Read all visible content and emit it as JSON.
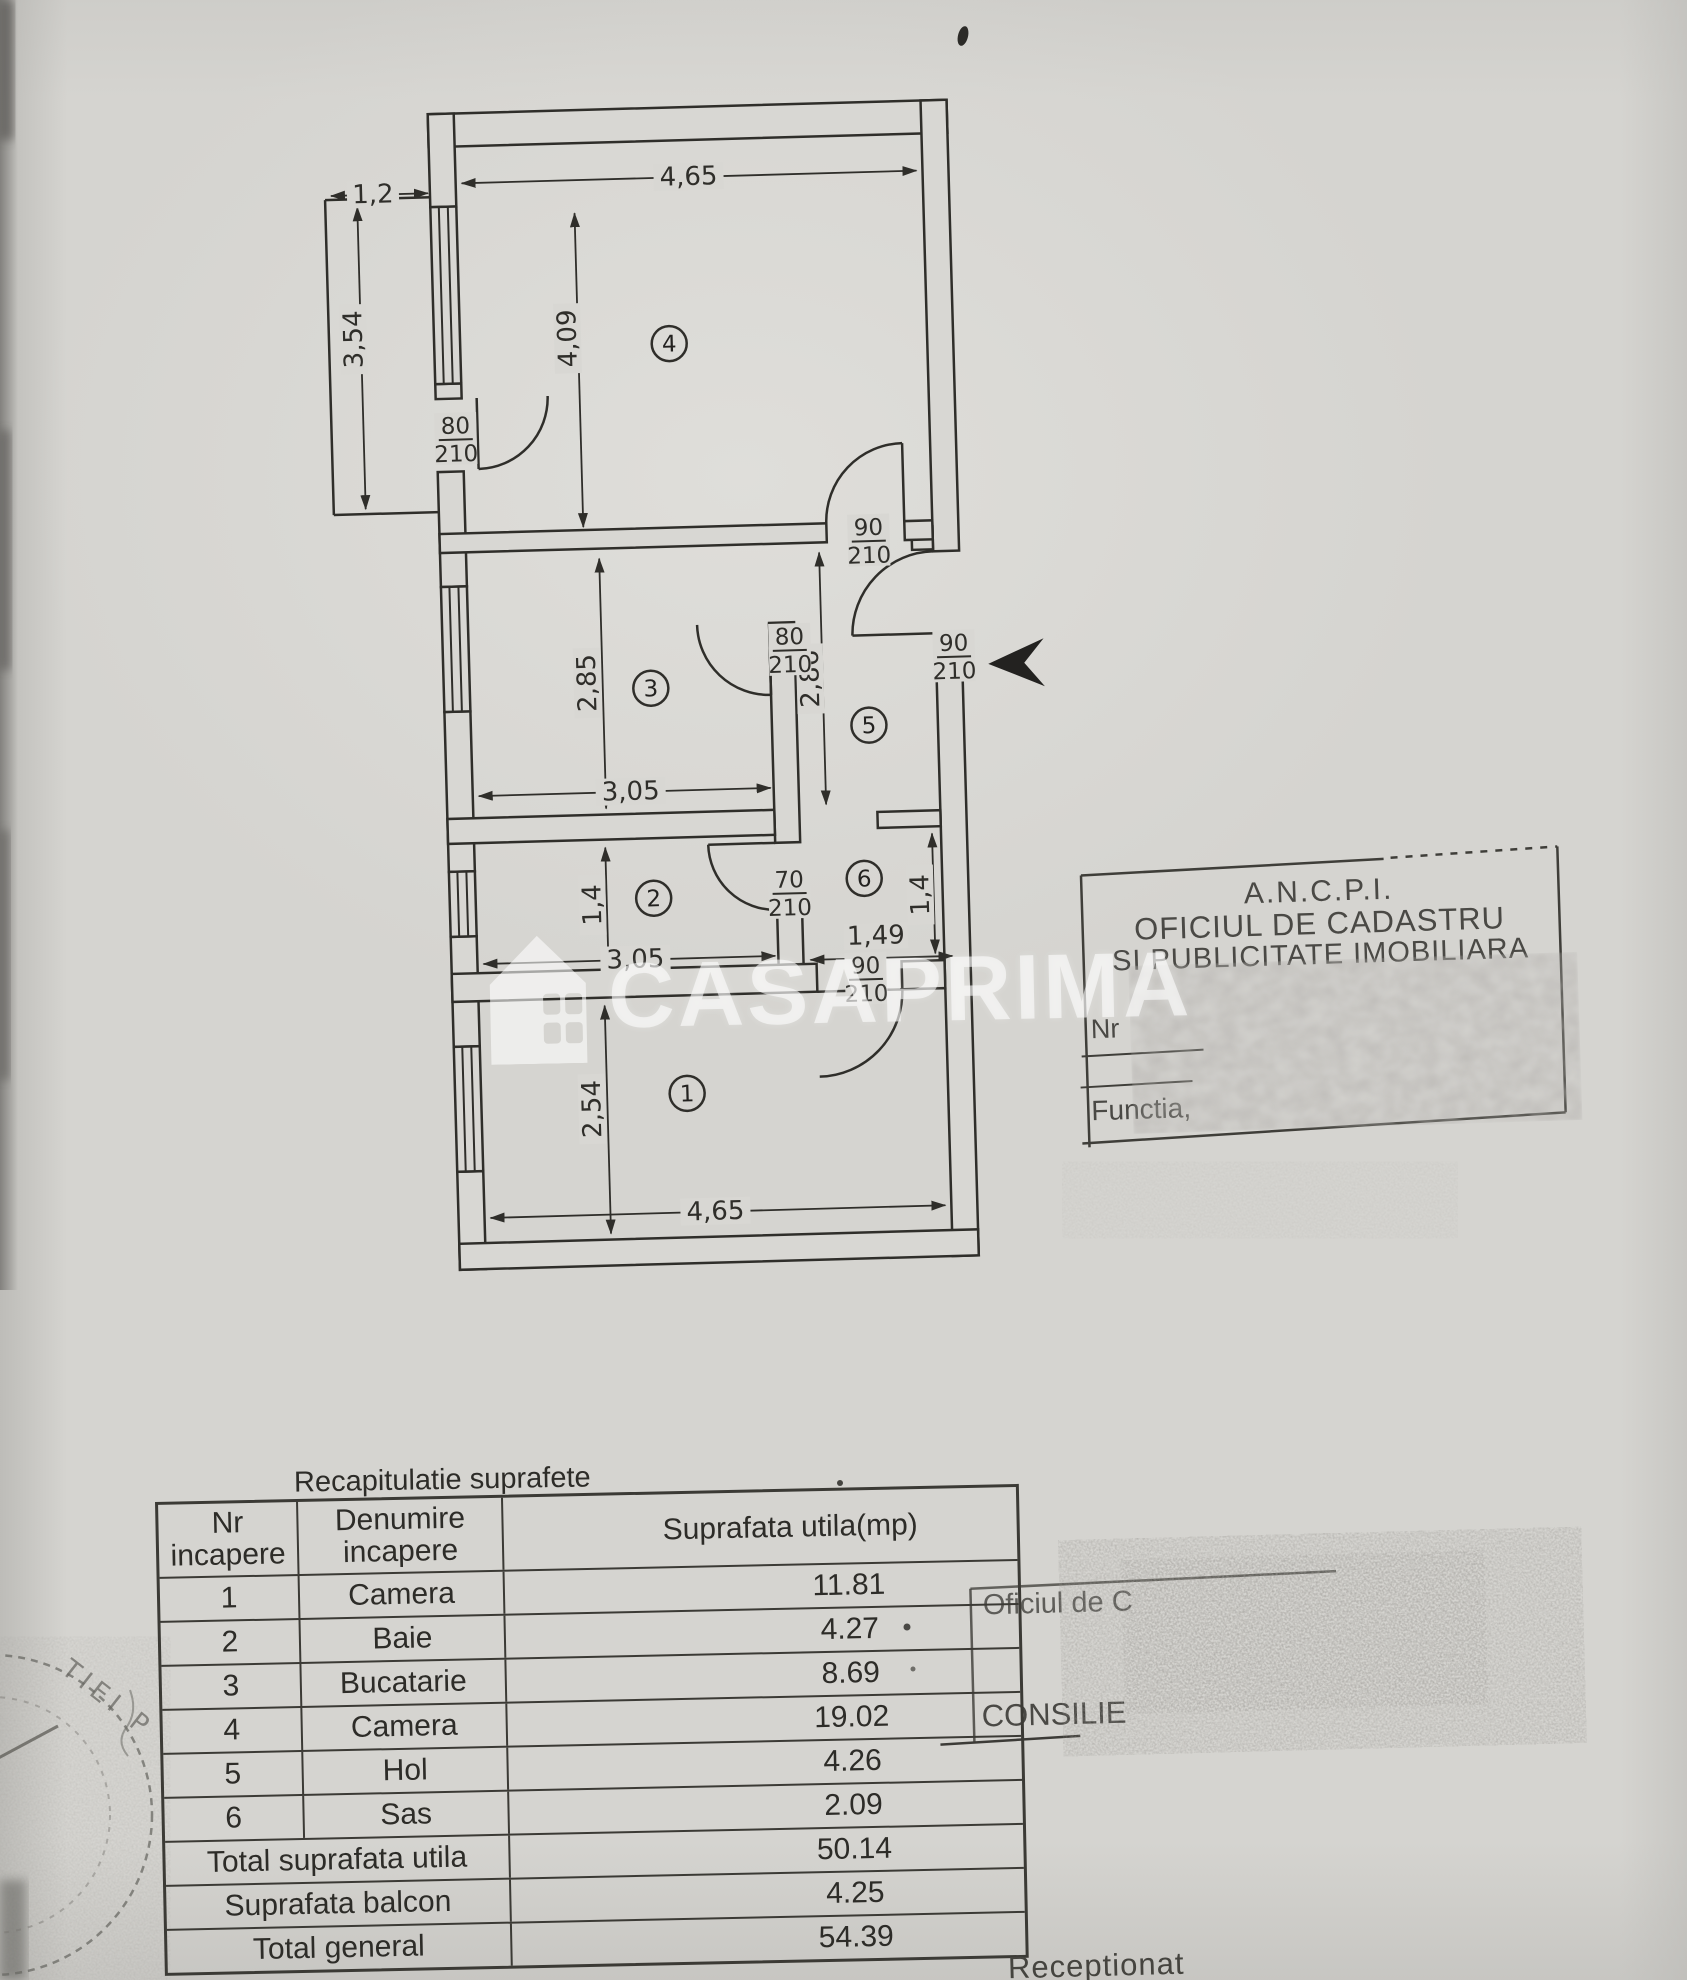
{
  "watermark": {
    "brand": "CASAPRIMA"
  },
  "plan": {
    "rooms": [
      {
        "number": "4"
      },
      {
        "number": "3"
      },
      {
        "number": "2"
      },
      {
        "number": "1"
      },
      {
        "number": "5"
      },
      {
        "number": "6"
      }
    ],
    "dims": {
      "balcony_w": "1,2",
      "balcony_h": "3,54",
      "room4_w": "4,65",
      "room4_h": "4,09",
      "room3_h": "2,85",
      "room3_w": "3,05",
      "hall_h": "2,86",
      "room2_h": "1,4",
      "room2_w": "3,05",
      "sas_h": "1,4",
      "sas_w": "1,49",
      "room1_h": "2,54",
      "room1_w": "4,65"
    },
    "doors": [
      {
        "w": "80",
        "h": "210"
      },
      {
        "w": "90",
        "h": "210"
      },
      {
        "w": "80",
        "h": "210"
      },
      {
        "w": "90",
        "h": "210"
      },
      {
        "w": "70",
        "h": "210"
      },
      {
        "w": "90",
        "h": "210"
      }
    ]
  },
  "ancpi_stamp": {
    "org": "A.N.C.P.I.",
    "line2": "OFICIUL DE CADASTRU",
    "line3": "SI PUBLICITATE IMOBILIARA",
    "nr_label": "Nr",
    "functie_label": "Functia,"
  },
  "office_stamp": {
    "line1": "Oficiul de C",
    "line2": "CONSILIE"
  },
  "round_stamp": {
    "arc_text": "TIEI P"
  },
  "page": {
    "receptionat_label": "Receptionat"
  },
  "table": {
    "title": "Recapitulatie suprafete",
    "headers": {
      "col1_line1": "Nr",
      "col1_line2": "incapere",
      "col2_line1": "Denumire",
      "col2_line2": "incapere",
      "col3": "Suprafata utila(mp)"
    },
    "rows": [
      {
        "nr": "1",
        "name": "Camera",
        "area": "11.81"
      },
      {
        "nr": "2",
        "name": "Baie",
        "area": "4.27"
      },
      {
        "nr": "3",
        "name": "Bucatarie",
        "area": "8.69"
      },
      {
        "nr": "4",
        "name": "Camera",
        "area": "19.02"
      },
      {
        "nr": "5",
        "name": "Hol",
        "area": "4.26"
      },
      {
        "nr": "6",
        "name": "Sas",
        "area": "2.09"
      }
    ],
    "totals": [
      {
        "label": "Total suprafata utila",
        "value": "50.14"
      },
      {
        "label": "Suprafata balcon",
        "value": "4.25"
      },
      {
        "label": "Total general",
        "value": "54.39"
      }
    ]
  },
  "colors": {
    "paper": "#d5d4d0",
    "ink": "#2f2e2a",
    "table_ink": "#3b3a35"
  }
}
